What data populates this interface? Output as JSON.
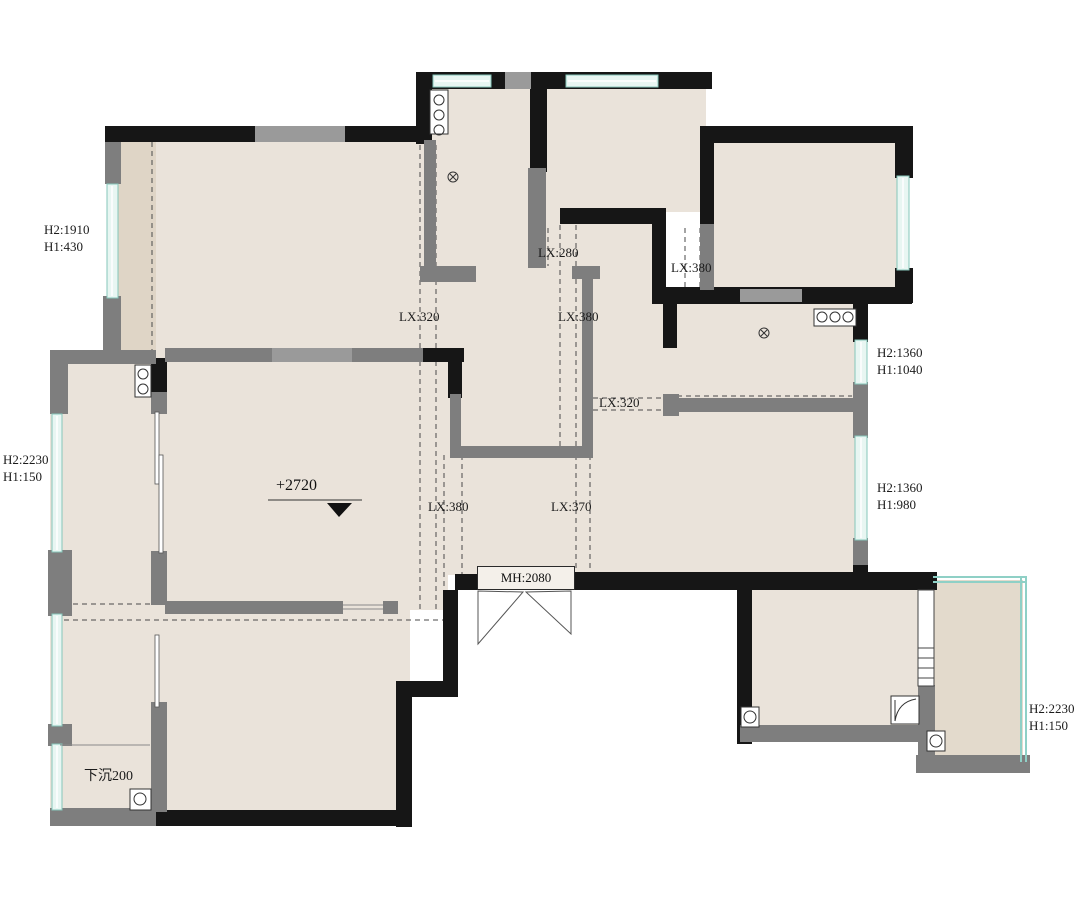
{
  "plan": {
    "title": "apartment-floor-plan",
    "elevation_marker": "+2720",
    "entry_door_label": "MH:2080",
    "sunken_label": "下沉200",
    "window_labels": [
      {
        "id": "left-top",
        "line1": "H2:1910",
        "line2": "H1:430"
      },
      {
        "id": "left-middle",
        "line1": "H2:2230",
        "line2": "H1:150"
      },
      {
        "id": "right-upper",
        "line1": "H2:1360",
        "line2": "H1:1040"
      },
      {
        "id": "right-lower",
        "line1": "H2:1360",
        "line2": "H1:980"
      },
      {
        "id": "bottom-right",
        "line1": "H2:2230",
        "line2": "H1:150"
      }
    ],
    "beam_labels": [
      {
        "id": "passage-top",
        "text": "LX:280"
      },
      {
        "id": "corridor-left",
        "text": "LX:320"
      },
      {
        "id": "corridor-mid",
        "text": "LX:380"
      },
      {
        "id": "bedroom-right",
        "text": "LX:380"
      },
      {
        "id": "dining-beam",
        "text": "LX:320"
      },
      {
        "id": "hall-left",
        "text": "LX:380"
      },
      {
        "id": "hall-right",
        "text": "LX:370"
      }
    ],
    "colors": {
      "floor": "#EAE3DA",
      "balcony_floor": "#E3DACC",
      "wall_black": "#161616",
      "wall_gray": "#7E7E7E",
      "wall_light_gray": "#9A9A9A",
      "window_fill": "#E8F6F2",
      "window_stroke": "#86C7BB"
    }
  }
}
